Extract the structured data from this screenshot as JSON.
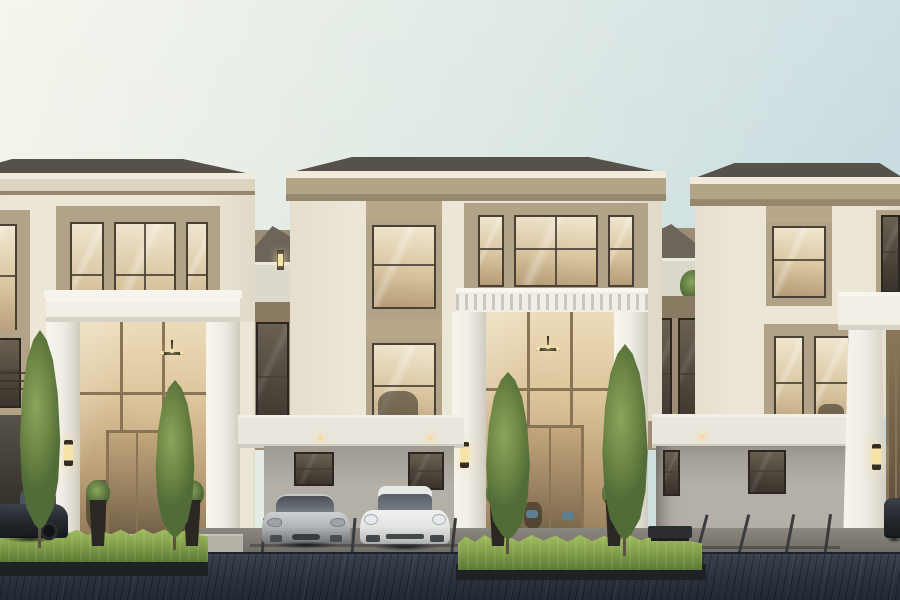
{
  "scene": {
    "description": "Exterior dusk rendering of a row of three modern-classical three-storey luxury townhomes with double-height white porticos, warm-lit glass interiors, slender cypress trees, clipped hedges and sports cars parked on a dark brick driveway",
    "setting": "residential street frontage, straight-on elevation view",
    "lighting": "dusk, warm interior glow, pale green-to-blue gradient sky",
    "buildings": [
      {
        "label": "left townhome",
        "features": [
          "hipped roof",
          "cream cornice",
          "triple third-floor window",
          "double-height white portico",
          "bronze-framed glass curtain wall",
          "chandelier",
          "wall sconce",
          "dark carport recess"
        ]
      },
      {
        "label": "middle townhome",
        "features": [
          "hipped roof",
          "taupe cornice",
          "white balustraded balcony",
          "double-height white portico",
          "glass entry doors",
          "chandelier",
          "carport with two sports cars",
          "recessed ceiling lights"
        ]
      },
      {
        "label": "right townhome",
        "features": [
          "hipped roof",
          "taupe cornice",
          "white portico pilaster",
          "glass entry door",
          "wall sconce",
          "empty carport with windows"
        ]
      }
    ],
    "link_terraces": [
      {
        "label": "terrace between left and middle homes",
        "features": [
          "dark sloped roof behind",
          "white parapet",
          "glowing wall lamp",
          "dark window below"
        ]
      },
      {
        "label": "terrace between middle and right homes",
        "features": [
          "dark sloped roof behind",
          "white parapet",
          "small shrub",
          "dark windows below"
        ]
      }
    ],
    "vehicles": [
      {
        "label": "dark sedan",
        "color": "charcoal",
        "location": "far-left carport, partially cropped"
      },
      {
        "label": "silver sports coupe",
        "color": "silver",
        "location": "centre-left parking stall"
      },
      {
        "label": "white sports coupe",
        "color": "white",
        "location": "centre parking stall"
      },
      {
        "label": "dark vehicle sliver",
        "color": "charcoal",
        "location": "far right edge, partially cropped"
      }
    ],
    "landscaping": {
      "cypress_trees": 4,
      "hedge_rows": 2,
      "planter_pots": 4,
      "terrace_shrub": 1
    },
    "street": {
      "paving": "dark diagonal brick driveway",
      "parking_stall_lines": true,
      "concrete_apron": true,
      "bench": 1
    }
  },
  "palette": {
    "sky-left": "#f3f4ea",
    "sky-mid": "#dde8e3",
    "sky-right": "#c2d7de",
    "roof-dark": "#56524a",
    "cornice-light": "#f0ebdd",
    "cornice-main": "#b4a487",
    "cornice-cream": "#dcd4c0",
    "cornice-shadow": "#97876c",
    "wall-cream": "#ece6d6",
    "trim-white": "#f1eee6",
    "trim-white-shade": "#d6d2c6",
    "frame-taupe": "#b2a288",
    "frame-dark": "#4a4034",
    "frame-bronze": "#8a7456",
    "glass-warm-hi": "#f0e6cf",
    "glass-warm": "#d8c5a0",
    "glass-warm-lo": "#b49b75",
    "glass-dark": "#4e463c",
    "link-wall": "#9d8d74",
    "link-roof": "#6e655a",
    "parapet": "#dcd8cc",
    "link-band": "#8a7a62",
    "carport-wall": "#b5b0a7",
    "carport-wall-dk": "#9f9a91",
    "beam-white": "#e9e6dd",
    "recess-dark": "#37342d",
    "apron": "#8b877e",
    "apron-dk": "#6b6861",
    "stall-line": "#393b3e",
    "drive-hi": "#3a4350",
    "drive-mid": "#2b313d",
    "drive-dk": "#232933",
    "drive-line": "#1d222c",
    "hedge-hi": "#a6c164",
    "hedge-mid": "#88a54d",
    "hedge-dk": "#5c7933",
    "planter-dark": "#1e2126",
    "tree-hi": "#8aa55c",
    "tree-mid": "#6d8644",
    "tree-dk": "#526c38",
    "trunk": "#5d5142",
    "car-silver-hi": "#ced1d3",
    "car-silver": "#b2b5b8",
    "car-silver-dk": "#888b8e",
    "car-white-hi": "#f0f1ef",
    "car-white": "#e2e4e2",
    "car-white-dk": "#c3c5c4",
    "car-dark": "#272b31",
    "glow-warm": "#f6e3a8",
    "light-dot": "#ffd894"
  }
}
